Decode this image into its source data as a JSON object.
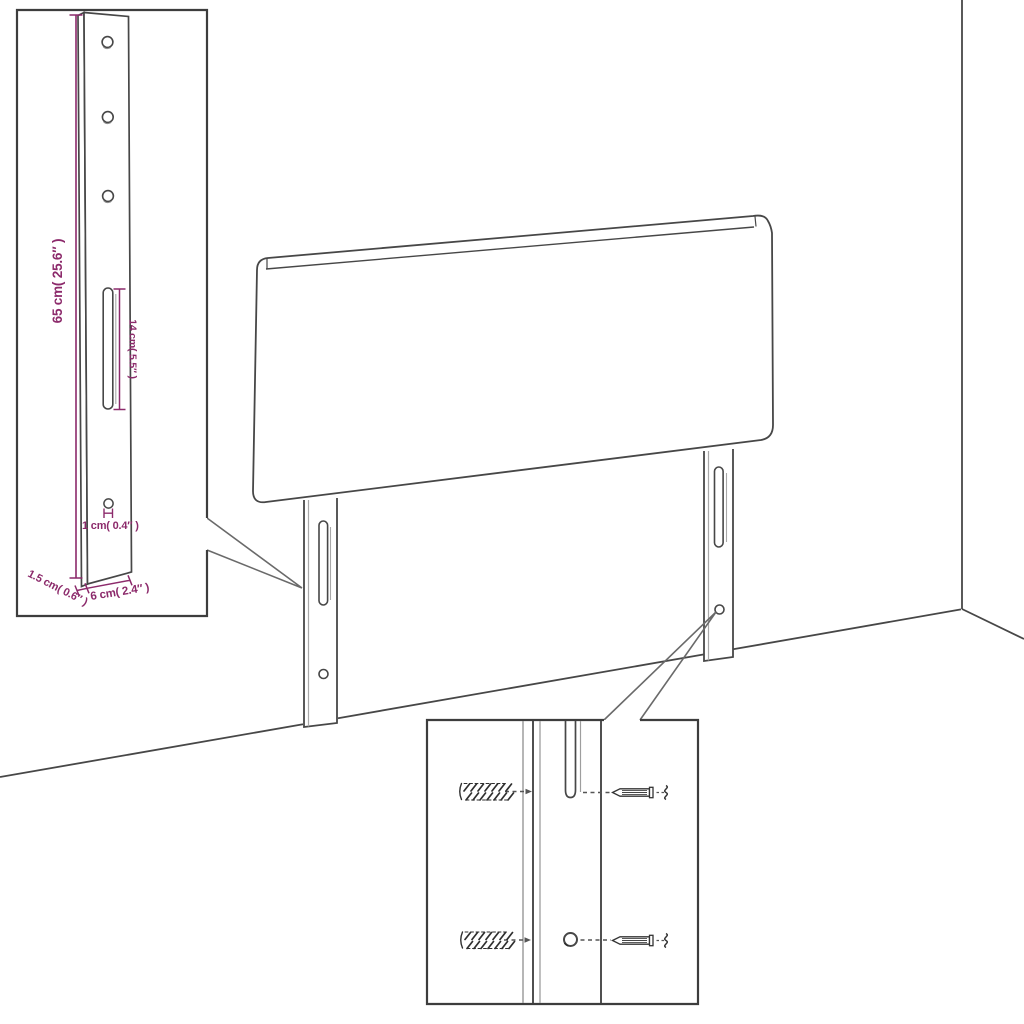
{
  "diagram": {
    "subject": "headboard-dimension-diagram",
    "dimensions": {
      "height": "65 cm( 25.6″ )",
      "slot_length": "14 cm( 5.5″ )",
      "hole_diameter": "1 cm( 0.4″ )",
      "thickness": "1.5 cm( 0.6″ )",
      "leg_width": "6 cm( 2.4″ )"
    },
    "colors": {
      "accent": "#8C2A6B",
      "line": "#474747",
      "light_line": "#a8a8a8",
      "box_border": "#3d3d3d",
      "background": "#ffffff"
    }
  }
}
